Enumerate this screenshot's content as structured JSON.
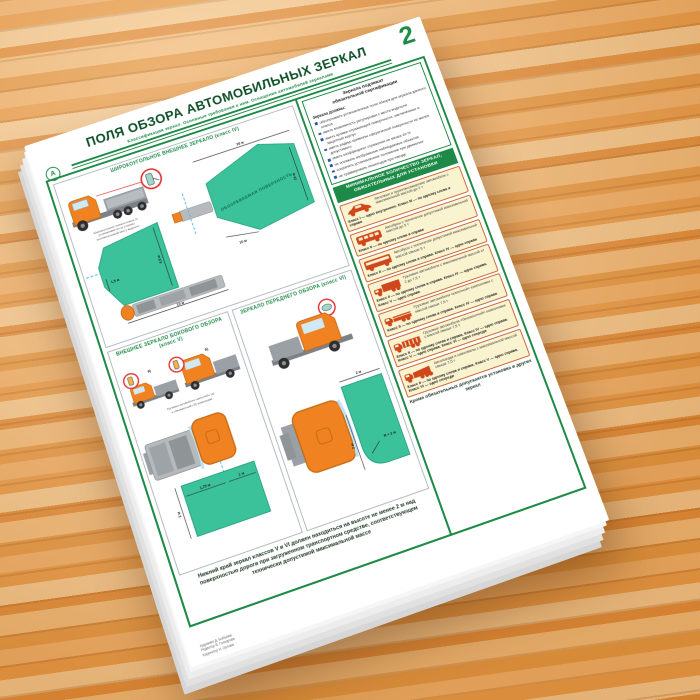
{
  "page_number": "2",
  "header": {
    "title": "ПОЛЯ ОБЗОРА АВТОМОБИЛЬНЫХ ЗЕРКАЛ",
    "subtitle": "Классификация зеркал. Основные требования к ним. Оснащение автомобилей зеркалами",
    "logo_glyph": "А"
  },
  "colors": {
    "accent_green": "#1d8a47",
    "field_green": "#3cc29b",
    "truck_orange": "#f08222",
    "card_yellow": "#f9f3cf",
    "vehicle_icon_red": "#d0451a",
    "guide_cyan": "#52b9e2"
  },
  "panel_wide": {
    "header": "ШИРОКОУГОЛЬНОЕ ВНЕШНЕЕ ЗЕРКАЛО (класс IV)",
    "caption_1": "Широкоугольное зеркало класса IV",
    "caption_2": "устанавливается со стороны,",
    "caption_3": "противоположной месту водителя",
    "surface_label": "ОБОЗРЕВАЕМАЯ ПОВЕРХНОСТЬ",
    "dim_25": "25 м",
    "dim_15": "15 м",
    "dim_45": "4,5 м",
    "dim_15s": "1,5 м",
    "dim_10_left": "10 м",
    "dim_10_right": "10 м"
  },
  "panel_side": {
    "header": "ВНЕШНЕЕ ЗЕРКАЛО БОКОВОГО ОБЗОРА (класс V)",
    "label_a": "а)",
    "label_b": "б)",
    "caption_1": "Грузовые автомобили «капотной» (а)",
    "caption_2": "и «бескапотной» (б) компоновки",
    "dim_2": "2 м",
    "dim_175": "1,75 м",
    "dim_1": "1 м"
  },
  "panel_front": {
    "header": "ЗЕРКАЛО ПЕРЕДНЕГО ОБЗОРА (класс VI)",
    "dim_top": "2 м",
    "dim_r": "R = 2 м",
    "dim_left": "2 м"
  },
  "bottom_note": "Нижний край зеркал классов V и VI должен находиться на высоте не менее 2 м над поверхностью дороги при загруженном транспортном средстве, соответствующем технически допустимой максимальной массе",
  "right_column": {
    "cert_title_1": "Зеркала подлежат",
    "cert_title_2": "обязательной сертификации",
    "cert_intro": "Зеркала должны:",
    "cert_items": [
      "обеспечивать установленные поля обзора для зеркала данного класса",
      "иметь возможность регулировки с места водителя",
      "иметь кромки отражающей поверхности, заключённые в защитный корпус",
      "иметь радиус кривизны сферической поверхности не менее допустимого",
      "иметь коэффициент отражения не менее 40 %",
      "не искажать изображение наблюдаемых объектов",
      "сохранять установленное положение при движении",
      "не травмировать пешеходов при наезде"
    ],
    "band": "МИНИМАЛЬНОЕ КОЛИЧЕСТВО ЗЕРКАЛ, ОБЯЗАТЕЛЬНЫХ ДЛЯ УСТАНОВКИ",
    "boxes": [
      {
        "text": "Легковые и грузопассажирские автомобили с максимальной массой до 2 т",
        "classes": "Класс I — одно внутреннее. Класс III — по одному слева и справа"
      },
      {
        "text": "Автобусы с технически допустимой максимальной массой до 5 т",
        "classes": "Класс II — по одному слева и справа"
      },
      {
        "text": "Автобусы с технически допустимой максимальной массой свыше 5 т",
        "classes": "Класс II — по одному слева и справа. Класс IV — одно справа"
      },
      {
        "text": "Грузовые автомобили с максимальной массой от 2 до 7,5 т",
        "classes": "Класс II — по одному слева и справа. Класс IV — одно справа. Класс V — одно справа"
      },
      {
        "text": "Грузовые автомобили «капотной» компоновки с массой свыше 7,5 т",
        "classes": "Класс II — по одному слева и справа. Класс IV — одно справа"
      },
      {
        "text": "Грузовые автомобили «бескапотной» компоновки с массой свыше 7,5 т",
        "classes": "Класс II — по одному слева и справа. Класс IV — одно справа. Класс V — одно справа. Класс VI — одно спереди"
      },
      {
        "text": "Автопоезда и самосвалы с максимальной массой свыше 7,5 т",
        "classes": "Класс II — по одному слева и справа. Класс V — одно справа. Класс VI — одно спереди"
      }
    ],
    "footer_note": "Кроме обязательных допускается установка и других зеркал"
  },
  "credits": {
    "line_1": "Художник Д. Бобылев",
    "line_2": "Редактор В. Гончарова",
    "line_3": "Корректор Н. Орлова"
  }
}
